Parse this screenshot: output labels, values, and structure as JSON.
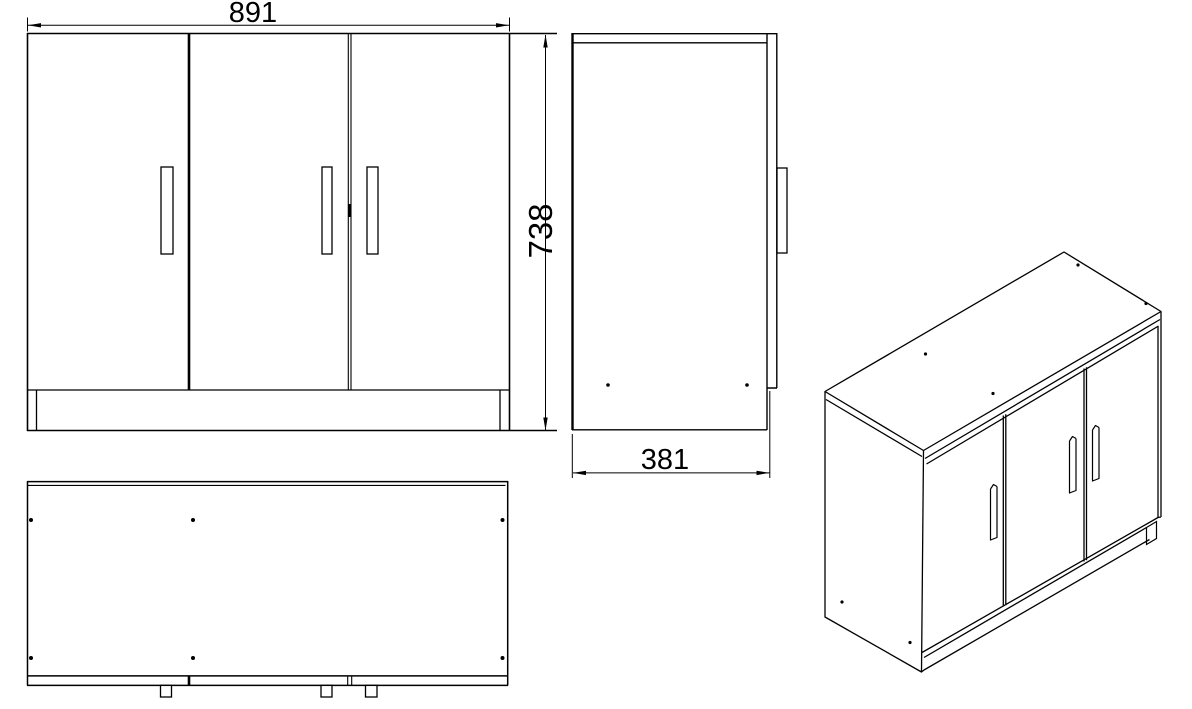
{
  "document": {
    "type": "technical-drawing",
    "subject": "three-door cabinet",
    "background_color": "#ffffff",
    "line_color": "#000000"
  },
  "dimensions": {
    "width": "891",
    "height": "738",
    "depth": "381"
  },
  "views": {
    "front": "front-view",
    "side": "side-view",
    "plan": "plan-view",
    "isometric": "isometric-view"
  }
}
